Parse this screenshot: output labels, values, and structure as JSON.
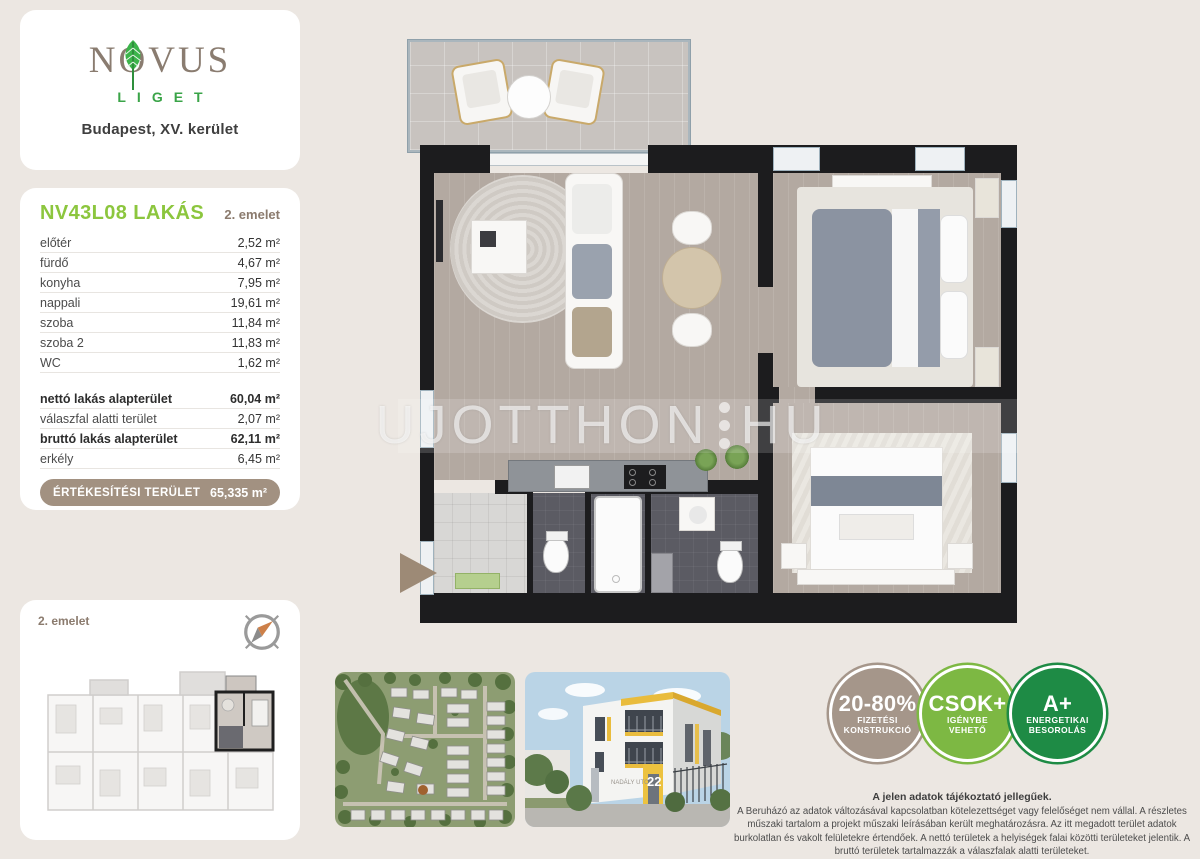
{
  "brand": {
    "name": "NOVUS",
    "subname": "LIGET",
    "location": "Budapest, XV. kerület"
  },
  "unit": {
    "title": "NV43L08 LAKÁS",
    "floor": "2. emelet",
    "rooms": [
      {
        "label": "előtér",
        "value": "2,52 m²"
      },
      {
        "label": "fürdő",
        "value": "4,67 m²"
      },
      {
        "label": "konyha",
        "value": "7,95 m²"
      },
      {
        "label": "nappali",
        "value": "19,61 m²"
      },
      {
        "label": "szoba",
        "value": "11,84 m²"
      },
      {
        "label": "szoba 2",
        "value": "11,83 m²"
      },
      {
        "label": "WC",
        "value": "1,62 m²"
      }
    ],
    "summary": [
      {
        "label": "nettó lakás alapterület",
        "value": "60,04 m²"
      },
      {
        "label": "válaszfal alatti terület",
        "value": "2,07 m²"
      },
      {
        "label": "bruttó lakás alapterület",
        "value": "62,11 m²"
      },
      {
        "label": "erkély",
        "value": "6,45 m²"
      }
    ],
    "sales": {
      "label": "ÉRTÉKESÍTÉSI TERÜLET",
      "value": "65,335 m²"
    }
  },
  "miniplan": {
    "floor_label": "2. emelet"
  },
  "building_render": {
    "street": "NADÁLY UTCA",
    "number": "22"
  },
  "watermark": {
    "left": "UJOTTHON",
    "right": "HU"
  },
  "badges": [
    {
      "line1": "20-80%",
      "line2": "FIZETÉSI",
      "line3": "KONSTRUKCIÓ",
      "color": "#a5968a"
    },
    {
      "line1": "CSOK+",
      "line2": "IGÉNYBE",
      "line3": "VEHETŐ",
      "color": "#7db843"
    },
    {
      "line1": "A+",
      "line2": "ENERGETIKAI",
      "line3": "BESOROLÁS",
      "color": "#1e8b45"
    }
  ],
  "disclaimer": {
    "title": "A jelen adatok tájékoztató jellegűek.",
    "body": "A Beruházó az adatok változásával kapcsolatban kötelezettséget vagy felelőséget nem vállal. A részletes műszaki tartalom a projekt műszaki leírásában került meghatározásra. Az itt megadott terület adatok burkolatlan és vakolt felületekre értendőek. A nettó területek a helyiségek falai közötti területeket jelentik. A bruttó területek tartalmazzák a válaszfalak alatti területeket."
  },
  "colors": {
    "page_bg": "#ece7e2",
    "accent_green": "#8cc63e",
    "brand_green": "#3aa448",
    "brand_taupe": "#8a7c70",
    "pill_brown": "#a29181",
    "wall_black": "#1c1c1e"
  }
}
